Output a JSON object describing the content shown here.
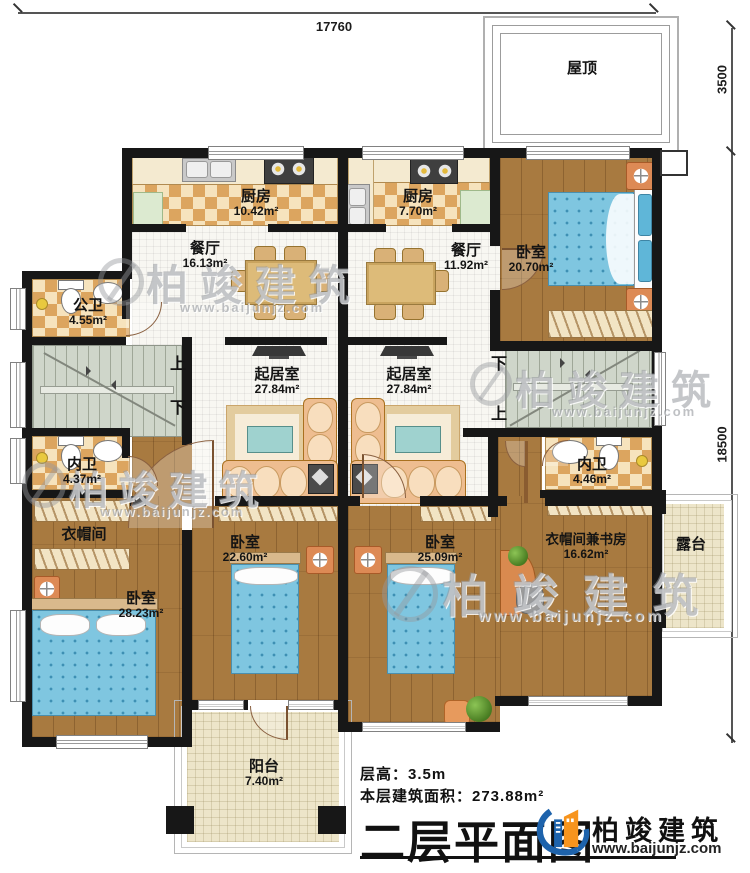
{
  "canvas": {
    "width": 750,
    "height": 873
  },
  "dimensions": {
    "top_width": "17760",
    "roof_depth": "3500",
    "body_depth": "18500"
  },
  "rooms": [
    {
      "id": "roof",
      "name": "屋顶",
      "area": ""
    },
    {
      "id": "kitchen1",
      "name": "厨房",
      "area": "10.42m²"
    },
    {
      "id": "kitchen2",
      "name": "厨房",
      "area": "7.70m²"
    },
    {
      "id": "dining1",
      "name": "餐厅",
      "area": "16.13m²"
    },
    {
      "id": "dining2",
      "name": "餐厅",
      "area": "11.92m²"
    },
    {
      "id": "bedroom-ne",
      "name": "卧室",
      "area": "20.70m²"
    },
    {
      "id": "pubbath",
      "name": "公卫",
      "area": "4.55m²"
    },
    {
      "id": "living1",
      "name": "起居室",
      "area": "27.84m²"
    },
    {
      "id": "living2",
      "name": "起居室",
      "area": "27.84m²"
    },
    {
      "id": "bath-w",
      "name": "内卫",
      "area": "4.37m²"
    },
    {
      "id": "bath-e",
      "name": "内卫",
      "area": "4.46m²"
    },
    {
      "id": "cloak",
      "name": "衣帽间",
      "area": ""
    },
    {
      "id": "bedroom-sw",
      "name": "卧室",
      "area": "28.23m²"
    },
    {
      "id": "bedroom-s1",
      "name": "卧室",
      "area": "22.60m²"
    },
    {
      "id": "bedroom-s2",
      "name": "卧室",
      "area": "25.09m²"
    },
    {
      "id": "cloakstudy",
      "name": "衣帽间兼书房",
      "area": "16.62m²"
    },
    {
      "id": "terrace",
      "name": "露台",
      "area": ""
    },
    {
      "id": "balcony",
      "name": "阳台",
      "area": "7.40m²"
    }
  ],
  "stairs": {
    "up": "上",
    "down": "下"
  },
  "footer": {
    "floor_height": "层高：3.5m",
    "floor_area": "本层建筑面积：273.88m²",
    "title": "二层平面图"
  },
  "brand": {
    "name": "柏竣建筑",
    "url": "www.baijunjz.com"
  },
  "watermark": {
    "name": "柏竣建筑",
    "url": "www.baijunjz.com"
  },
  "colors": {
    "wall": "#171717",
    "wood_floor": "#a87a40",
    "tile_accent": "#dca55f",
    "bed": "#7fc6e0",
    "stairs": "#cfd6ca",
    "logo_blue": "#1e63ac",
    "logo_orange": "#f7941d"
  }
}
